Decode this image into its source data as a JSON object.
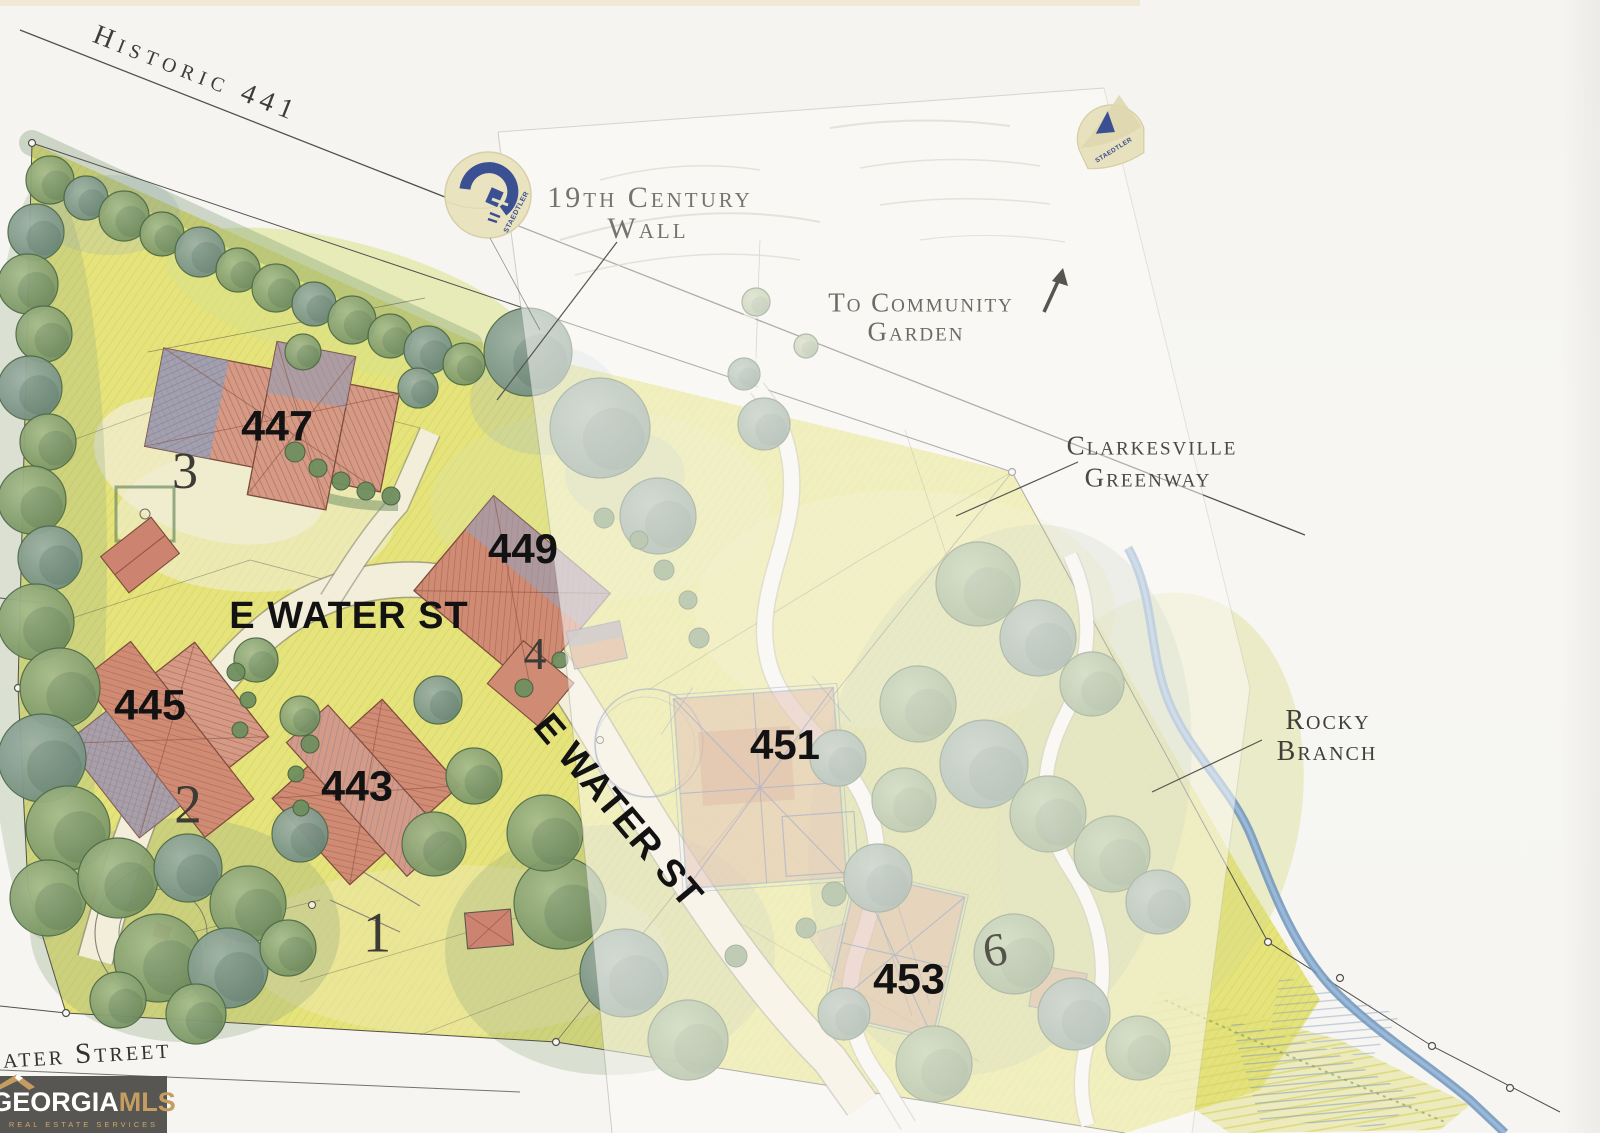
{
  "map": {
    "road_labels": {
      "historic_441": "Historic 441",
      "e_water_st": "E WATER ST",
      "water_street": "Water Street"
    },
    "landmarks": {
      "wall_line1": "19th Century",
      "wall_line2": "Wall",
      "garden_line1": "To Community",
      "garden_line2": "Garden",
      "greenway_line1": "Clarkesville",
      "greenway_line2": "Greenway",
      "branch_line1": "Rocky",
      "branch_line2": "Branch"
    },
    "addresses": {
      "a443": "443",
      "a445": "445",
      "a447": "447",
      "a449": "449",
      "a451": "451",
      "a453": "453"
    },
    "lots": {
      "lot1": "1",
      "lot2": "2",
      "lot3": "3",
      "lot4": "4",
      "lot6": "6"
    },
    "sticker_brand": "STAEDTLER"
  },
  "logo": {
    "brand_primary": "GEORGIA",
    "brand_secondary": "MLS",
    "tagline": "REAL ESTATE SERVICES"
  },
  "colors": {
    "lawn_yellow": "#e7e37b",
    "tree_green": "#75915f",
    "roof_red": "#cf8b74",
    "roof_blue_gray": "#93a0b8",
    "stream_blue": "#6f94bd",
    "label_gray": "#55534e",
    "annotation_black": "#121212",
    "logo_background": "#575652",
    "logo_gold": "#c59d61"
  }
}
